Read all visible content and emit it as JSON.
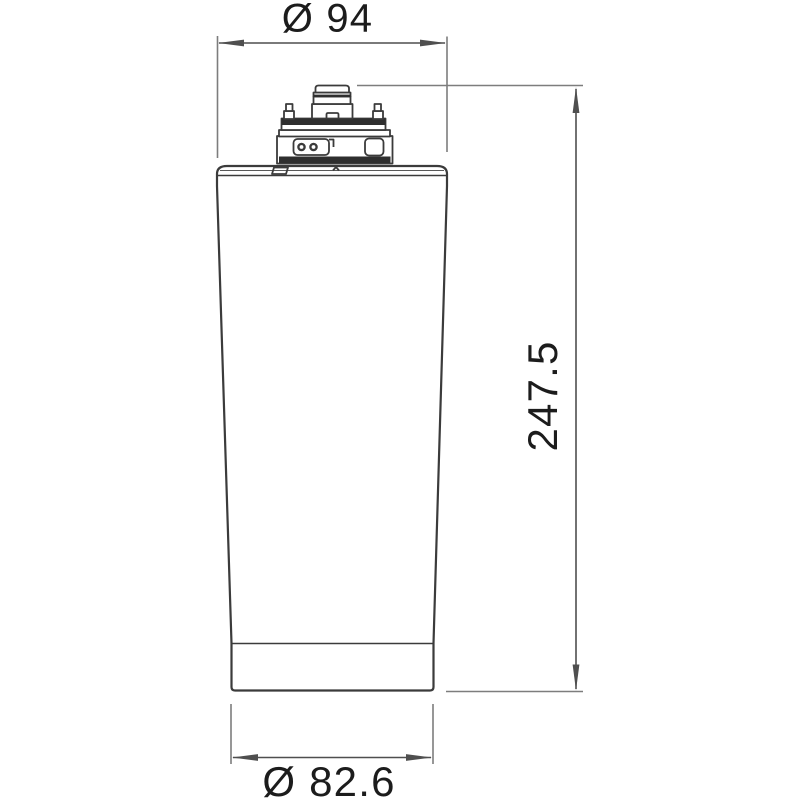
{
  "drawing": {
    "type": "technical-dimension-drawing",
    "subject": "filter-cartridge-side-view",
    "colors": {
      "background": "#ffffff",
      "outline": "#3b3b3b",
      "dark_fill": "#2e2e2e",
      "dimension_line": "#4f4f4f",
      "extension_line": "#7d7d7d",
      "text": "#1c1c1c"
    },
    "dimensions": {
      "top_diameter": {
        "label": "Ø 94",
        "value": 94,
        "kind": "diameter",
        "position": "top"
      },
      "height": {
        "label": "247.5",
        "value": 247.5,
        "kind": "height",
        "position": "right"
      },
      "bottom_diameter": {
        "label": "Ø 82.6",
        "value": 82.6,
        "kind": "diameter",
        "position": "bottom"
      }
    }
  }
}
